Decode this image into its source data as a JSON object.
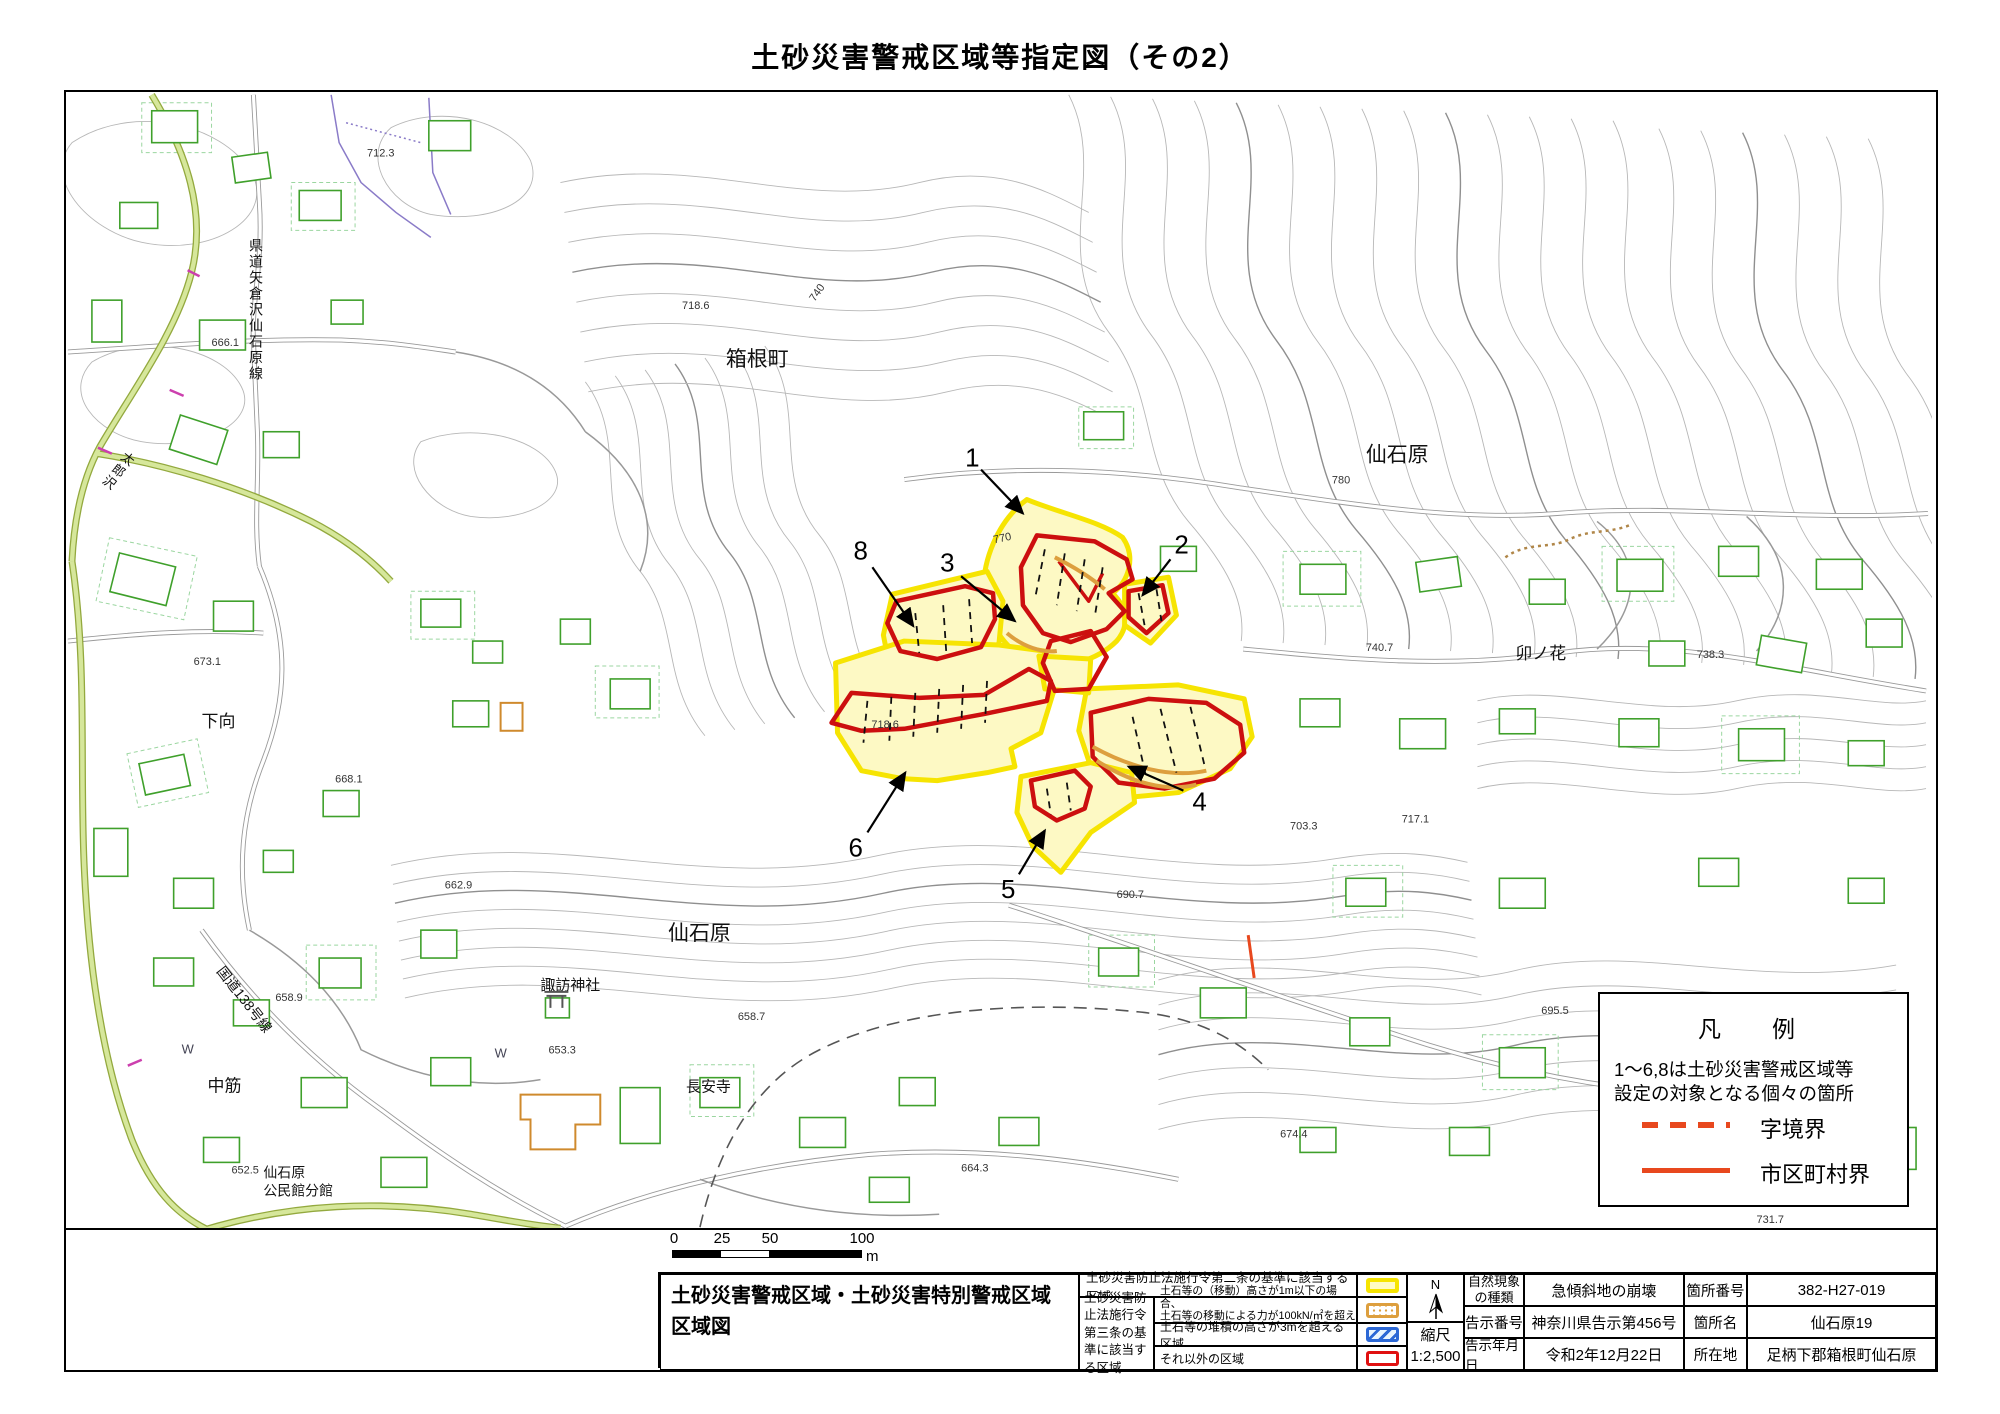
{
  "title": "土砂災害警戒区域等指定図（その2）",
  "colors": {
    "warning_zone_yellow_border": "#f6e402",
    "warning_zone_yellow_fill": "#fdf9c4",
    "special_zone_red": "#cc0f0f",
    "law3_orange": "#dd9f3e",
    "law3_blue": "#2c68d5",
    "boundary_red": "#e8481e",
    "road_green": "#d6e79b",
    "building_green": "#3fa02b"
  },
  "map": {
    "towns": {
      "hakone": "箱根町",
      "sengokuhara_ne": "仙石原",
      "unohana": "卯ノ花",
      "shimomukai": "下向",
      "sengokuhara_s": "仙石原",
      "suwa_shrine": "諏訪神社",
      "nakasuji": "中筋",
      "choanji": "長安寺",
      "kominkan_line1": "仙石原",
      "kominkan_line2": "公民館分館",
      "route138": "国道138号線",
      "kendo": "県道矢倉沢仙石原線",
      "tarosawa": "太郎沢"
    },
    "site_numbers": {
      "n1": "1",
      "n2": "2",
      "n3": "3",
      "n4": "4",
      "n5": "5",
      "n6": "6",
      "n8": "8"
    },
    "elevations": {
      "e1": "718.6",
      "e2": "740",
      "e3": "780",
      "e4": "770",
      "e5": "740.7",
      "e6": "738.3",
      "e7": "673.1",
      "e8": "668.1",
      "e9": "662.9",
      "e10": "658.9",
      "e11": "653.3",
      "e12": "652.5",
      "e13": "658.7",
      "e14": "664.3",
      "e15": "690.7",
      "e16": "718.6",
      "e17": "695.5",
      "e18": "674.4",
      "e19": "731.7",
      "e20": "703.3",
      "e21": "712.3",
      "e22": "666.1",
      "e23": "717.1"
    },
    "water_marks": {
      "w1": "W",
      "w2": "W"
    }
  },
  "legend_box": {
    "title": "凡　例",
    "line1": "1～6,8は土砂災害警戒区域等",
    "line2": "設定の対象となる個々の箇所",
    "dashed_label": "字境界",
    "solid_label": "市区町村界"
  },
  "scale_bar": {
    "t0": "0",
    "t25": "25",
    "t50": "50",
    "t100": "100",
    "unit": "m"
  },
  "table": {
    "map_title_line1": "土砂災害警戒区域・土砂災害特別警戒区域",
    "map_title_line2": "区域図",
    "law2_label": "土砂災害防止法施行令第二条の基準に該当する区域",
    "law3_label": "土砂災害防止法施行令第三条の基準に該当する区域",
    "row2_desc_line1": "土石等の（移動）高さが1m以下の場合、",
    "row2_desc_line2": "土石等の移動による力が100kN/㎡を超える区域",
    "row3_desc": "土石等の堆積の高さが3mを超える区域",
    "row4_desc": "それ以外の区域",
    "compass_n": "N",
    "scale_label": "縮尺",
    "scale_value": "1:2,500",
    "nat_label": "自然現象の種類",
    "nat_value": "急傾斜地の崩壊",
    "notice_label": "告示番号",
    "notice_value": "神奈川県告示第456号",
    "date_label": "告示年月日",
    "date_value": "令和2年12月22日",
    "no_label": "箇所番号",
    "no_value": "382-H27-019",
    "name_label": "箇所名",
    "name_value": "仙石原19",
    "addr_label": "所在地",
    "addr_value": "足柄下郡箱根町仙石原"
  }
}
